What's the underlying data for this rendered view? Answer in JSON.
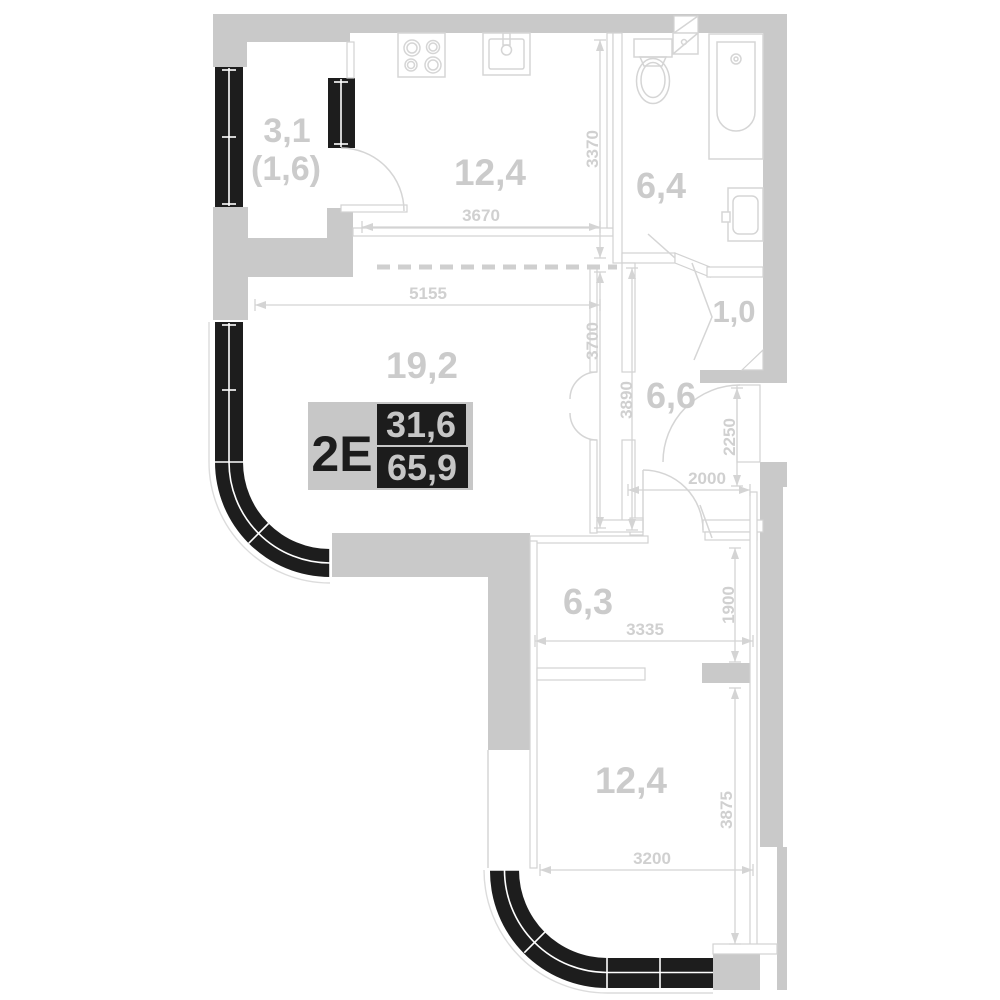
{
  "plan_type": "apartment-floor-plan",
  "badge": {
    "unit_type": "2Е",
    "value_top": "31,6",
    "value_bottom": "65,9"
  },
  "rooms": {
    "balcony": {
      "area": "3,1",
      "area_secondary": "(1,6)"
    },
    "kitchen": {
      "area": "12,4"
    },
    "bathroom": {
      "area": "6,4"
    },
    "storage": {
      "area": "1,0"
    },
    "hallway": {
      "area": "6,6"
    },
    "living": {
      "area": "19,2"
    },
    "corridor": {
      "area": "6,3"
    },
    "bedroom": {
      "area": "12,4"
    }
  },
  "dimensions": {
    "kitchen_height": "3370",
    "kitchen_width": "3670",
    "living_width": "5155",
    "living_height": "3700",
    "hall_height": "3890",
    "entry_height": "2250",
    "hall_width": "2000",
    "corridor_height": "1900",
    "corridor_width": "3335",
    "bedroom_height": "3875",
    "bedroom_width": "3200"
  },
  "fixtures": [
    "stove",
    "kitchen-sink",
    "toilet",
    "corner-sink",
    "bathtub",
    "washing-machine"
  ],
  "colors": {
    "background": "#ffffff",
    "wall": "#c9c9c9",
    "window_wall": "#1d1d1d",
    "thin_line": "#d4d4d4",
    "label": "#cbcbcb",
    "badge_black": "#1c1c1c",
    "badge_gray": "#c7c7c7"
  }
}
